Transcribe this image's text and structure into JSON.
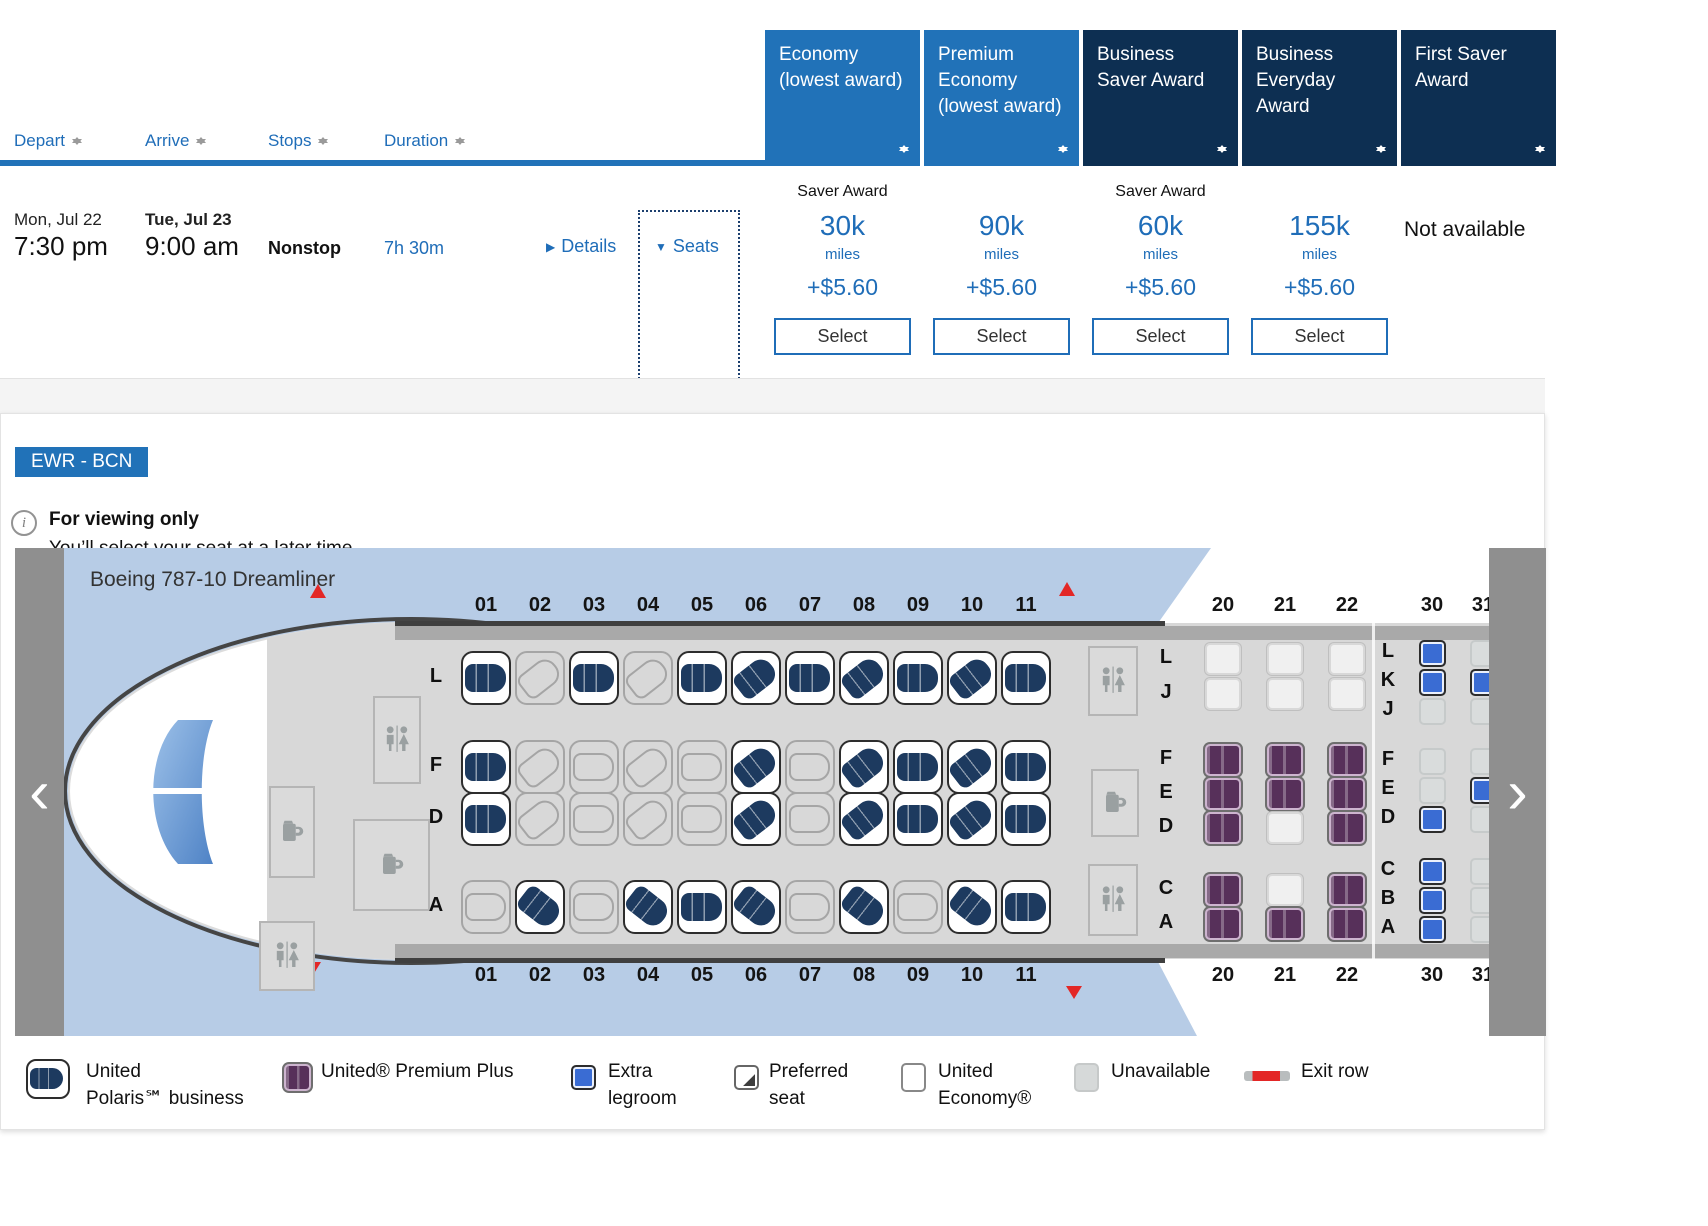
{
  "colors": {
    "accent_blue": "#2172b8",
    "navy": "#0d2f52",
    "link_blue": "#1f6db8",
    "polaris_seat": "#1d3a5f",
    "premium_seat": "#57305a",
    "extra_legroom_seat": "#3a6cd3",
    "unavailable_seat": "#d9dcdc",
    "exit_red": "#e32726",
    "sky": "#b7cce6",
    "cabin_floor": "#d8d8d8"
  },
  "results": {
    "sort_columns": [
      {
        "label": "Depart"
      },
      {
        "label": "Arrive"
      },
      {
        "label": "Stops"
      },
      {
        "label": "Duration"
      }
    ],
    "fare_columns": [
      {
        "label": "Economy (lowest award)",
        "bg": "#2172b8",
        "saver_label": "Saver Award",
        "miles": "30k",
        "miles_unit": "miles",
        "fees": "+$5.60",
        "select_label": "Select"
      },
      {
        "label": "Premium Economy (lowest award)",
        "bg": "#2172b8",
        "saver_label": "",
        "miles": "90k",
        "miles_unit": "miles",
        "fees": "+$5.60",
        "select_label": "Select"
      },
      {
        "label": "Business Saver Award",
        "bg": "#0d2f52",
        "saver_label": "Saver Award",
        "miles": "60k",
        "miles_unit": "miles",
        "fees": "+$5.60",
        "select_label": "Select"
      },
      {
        "label": "Business Everyday Award",
        "bg": "#0d2f52",
        "saver_label": "",
        "miles": "155k",
        "miles_unit": "miles",
        "fees": "+$5.60",
        "select_label": "Select"
      },
      {
        "label": "First Saver Award",
        "bg": "#0d2f52",
        "not_available": "Not available"
      }
    ],
    "flight": {
      "depart_date": "Mon, Jul 22",
      "depart_time": "7:30 pm",
      "arrive_date": "Tue, Jul 23",
      "arrive_time": "9:00 am",
      "stops": "Nonstop",
      "duration": "7h 30m",
      "details_label": "Details",
      "seats_label": "Seats"
    }
  },
  "seat_panel": {
    "route": "EWR - BCN",
    "notice_title": "For viewing only",
    "notice_subtitle": "You’ll select your seat at a later time.",
    "aircraft": "Boeing 787-10 Dreamliner",
    "seatmap": {
      "business": {
        "columns": [
          "01",
          "02",
          "03",
          "04",
          "05",
          "06",
          "07",
          "08",
          "09",
          "10",
          "11"
        ],
        "rows": [
          {
            "letter": "L",
            "seats": [
              "b",
              "u",
              "b",
              "u",
              "b",
              "b",
              "b",
              "b",
              "b",
              "b",
              "b"
            ]
          },
          {
            "letter": "F",
            "seats": [
              "b",
              "u",
              "u",
              "u",
              "u",
              "b",
              "u",
              "b",
              "b",
              "b",
              "b"
            ]
          },
          {
            "letter": "D",
            "seats": [
              "b",
              "u",
              "u",
              "u",
              "u",
              "b",
              "u",
              "b",
              "b",
              "b",
              "b"
            ]
          },
          {
            "letter": "A",
            "seats": [
              "u",
              "b",
              "u",
              "b",
              "b",
              "b",
              "u",
              "b",
              "u",
              "b",
              "b"
            ]
          }
        ]
      },
      "premium": {
        "columns": [
          "20",
          "21",
          "22"
        ],
        "rows": [
          {
            "letter": "L",
            "seats": [
              "n",
              "n",
              "n"
            ]
          },
          {
            "letter": "J",
            "seats": [
              "n",
              "n",
              "n"
            ]
          },
          {
            "letter": "F",
            "seats": [
              "p",
              "p",
              "p"
            ]
          },
          {
            "letter": "E",
            "seats": [
              "p",
              "p",
              "p"
            ]
          },
          {
            "letter": "D",
            "seats": [
              "p",
              "n",
              "p"
            ]
          },
          {
            "letter": "C",
            "seats": [
              "p",
              "n",
              "p"
            ]
          },
          {
            "letter": "A",
            "seats": [
              "p",
              "p",
              "p"
            ]
          }
        ]
      },
      "economy": {
        "columns": [
          "30",
          "31"
        ],
        "rows": [
          {
            "letter": "L",
            "seats": [
              "x",
              "n"
            ]
          },
          {
            "letter": "K",
            "seats": [
              "x",
              "x"
            ]
          },
          {
            "letter": "J",
            "seats": [
              "n",
              "n"
            ]
          },
          {
            "letter": "F",
            "seats": [
              "n",
              "n"
            ]
          },
          {
            "letter": "E",
            "seats": [
              "n",
              "x"
            ]
          },
          {
            "letter": "D",
            "seats": [
              "x",
              "n"
            ]
          },
          {
            "letter": "C",
            "seats": [
              "x",
              "n"
            ]
          },
          {
            "letter": "B",
            "seats": [
              "x",
              "n"
            ]
          },
          {
            "letter": "A",
            "seats": [
              "x",
              "n"
            ]
          }
        ]
      }
    },
    "legend": [
      {
        "type": "polaris",
        "line1": "United",
        "line2": "Polaris℠ business"
      },
      {
        "type": "premium",
        "line1": "United® Premium Plus",
        "line2": ""
      },
      {
        "type": "extra",
        "line1": "Extra",
        "line2": "legroom"
      },
      {
        "type": "preferred",
        "line1": "Preferred",
        "line2": "seat"
      },
      {
        "type": "economy",
        "line1": "United",
        "line2": "Economy®"
      },
      {
        "type": "unavailable",
        "line1": "Unavailable",
        "line2": ""
      },
      {
        "type": "exitrow",
        "line1": "Exit row",
        "line2": ""
      }
    ]
  }
}
